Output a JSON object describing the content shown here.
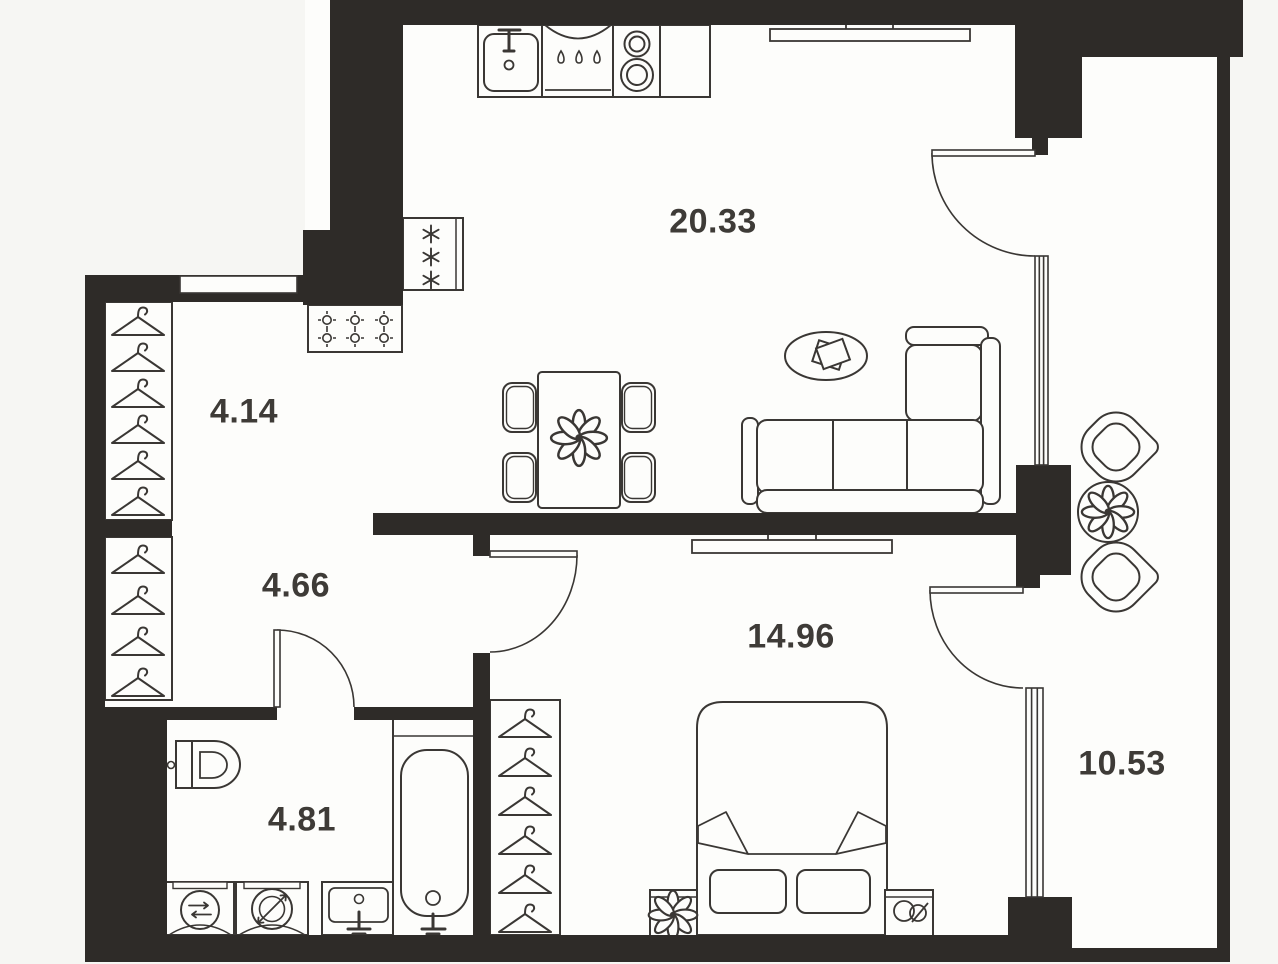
{
  "app": {
    "view": "apartment-floor-plan"
  },
  "colors": {
    "background": "#f6f6f3",
    "floor": "#fdfdfb",
    "wall": "#2e2b28",
    "line": "#3a3734",
    "label": "#3e3b37"
  },
  "rooms": [
    {
      "name": "kitchen-living-room",
      "area": "20.33"
    },
    {
      "name": "entry-hall",
      "area": "4.14"
    },
    {
      "name": "corridor",
      "area": "4.66"
    },
    {
      "name": "bedroom",
      "area": "14.96"
    },
    {
      "name": "bathroom",
      "area": "4.81"
    },
    {
      "name": "balcony",
      "area": "10.53"
    }
  ],
  "fixtures": [
    "kitchen-sink",
    "dishwasher",
    "stove",
    "fridge",
    "counter",
    "dining-table",
    "dining-chairs",
    "flower-centerpiece",
    "corner-sofa",
    "coffee-table",
    "wall-shelf",
    "tv-console",
    "entry-door",
    "utility-shaft",
    "hall-wardrobe",
    "corridor-wardrobe",
    "bathroom-door",
    "toilet",
    "washing-machine",
    "dryer",
    "wash-basin",
    "bathtub",
    "bedroom-door",
    "bedroom-wardrobe",
    "double-bed",
    "pillows",
    "nightstand-plant",
    "nightstand-clock",
    "balcony-door-living",
    "balcony-door-bedroom",
    "balcony-glazing",
    "balcony-table-plant",
    "balcony-chairs"
  ]
}
